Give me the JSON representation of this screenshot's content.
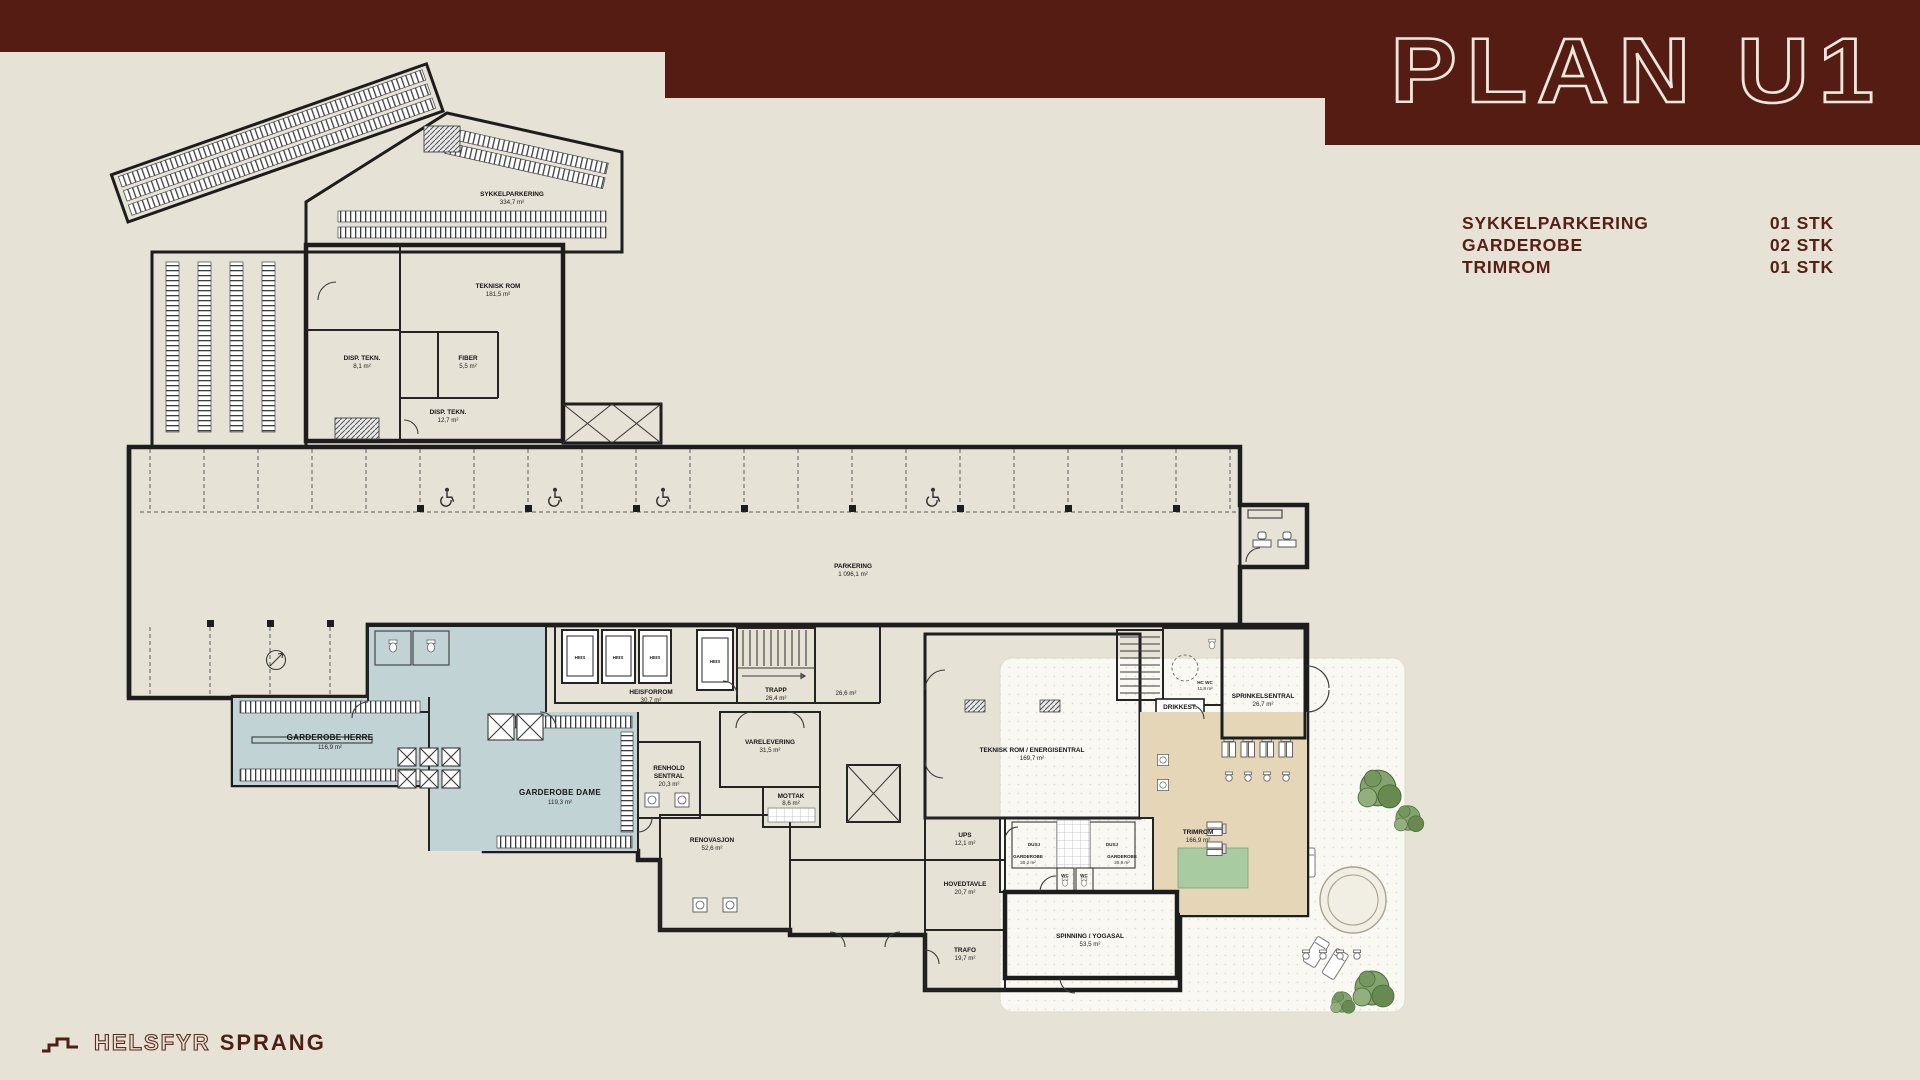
{
  "header": {
    "title": "PLAN U1"
  },
  "legend": {
    "items": [
      {
        "label": "SYKKELPARKERING",
        "value": "01 STK"
      },
      {
        "label": "GARDEROBE",
        "value": "02 STK"
      },
      {
        "label": "TRIMROM",
        "value": "01 STK"
      }
    ]
  },
  "brand": {
    "outline": "HELSFYR",
    "solid": "SPRANG"
  },
  "icons": {
    "wheelchair": "accessible parking symbol",
    "tree": "tree canopy",
    "lounger": "sun lounger",
    "logo_steps": "staircase brand mark"
  },
  "colors": {
    "maroon": "#541c13",
    "beige": "#e6e2d6",
    "cream": "#ece7db",
    "garderobe": "#c2d3d6",
    "trimrom": "#e6d6b8",
    "spinning": "#b9c7b0",
    "mat": "#a9cba2",
    "hcwc": "#bac4cf",
    "dusj": "#d7dcde",
    "parking": "#ececeb",
    "outdoor": "#faf8f2"
  },
  "rooms": {
    "sykkelparkering": {
      "name": "SYKKELPARKERING",
      "area": "334,7 m²"
    },
    "teknisk_rom": {
      "name": "TEKNISK ROM",
      "area": "181,5 m²"
    },
    "disp_tekn_1": {
      "name": "DISP. TEKN.",
      "area": "8,1 m²"
    },
    "fiber": {
      "name": "FIBER",
      "area": "5,5 m²"
    },
    "disp_tekn_2": {
      "name": "DISP. TEKN.",
      "area": "12,7 m²"
    },
    "parkering": {
      "name": "PARKERING",
      "area": "1 096,1 m²"
    },
    "heis": {
      "name": "HEIS"
    },
    "heisforrom": {
      "name": "HEISFORROM",
      "area": "30,7 m²"
    },
    "trapp": {
      "name": "TRAPP",
      "area": "26,4 m²"
    },
    "rom_26": {
      "area": "26,6 m²"
    },
    "garderobe_herre": {
      "name": "GARDEROBE HERRE",
      "area": "116,9 m²"
    },
    "garderobe_dame": {
      "name": "GARDEROBE DAME",
      "area": "119,3 m²"
    },
    "renhold": {
      "name1": "RENHOLD",
      "name2": "SENTRAL",
      "area": "20,3 m²"
    },
    "varelevering": {
      "name": "VARELEVERING",
      "area": "31,5 m²"
    },
    "mottak": {
      "name": "MOTTAK",
      "area": "8,6 m²"
    },
    "renovasjon": {
      "name": "RENOVASJON",
      "area": "52,6 m²"
    },
    "energisentral": {
      "name": "TEKNISK ROM / ENERGISENTRAL",
      "area": "169,7 m²"
    },
    "hc_wc": {
      "name": "HC WC",
      "area": "11,8 m²"
    },
    "drikkest": {
      "name": "DRIKKEST."
    },
    "sprinkelsentral": {
      "name": "SPRINKELSENTRAL",
      "area": "26,7 m²"
    },
    "trimrom": {
      "name": "TRIMROM",
      "area": "166,9 m²"
    },
    "ups": {
      "name": "UPS",
      "area": "12,1 m²"
    },
    "hovedtavle": {
      "name": "HOVEDTAVLE",
      "area": "20,7 m²"
    },
    "trafo": {
      "name": "TRAFO",
      "area": "19,7 m²"
    },
    "dusj": {
      "name": "DUSJ"
    },
    "garderobe_1": {
      "name": "GARDEROBE",
      "area": "20,2 m²"
    },
    "garderobe_2": {
      "name": "GARDEROBE",
      "area": "20,9 m²"
    },
    "wc": {
      "name": "WC"
    },
    "spinning": {
      "name": "SPINNING / YOGASAL",
      "area": "53,5 m²"
    }
  }
}
